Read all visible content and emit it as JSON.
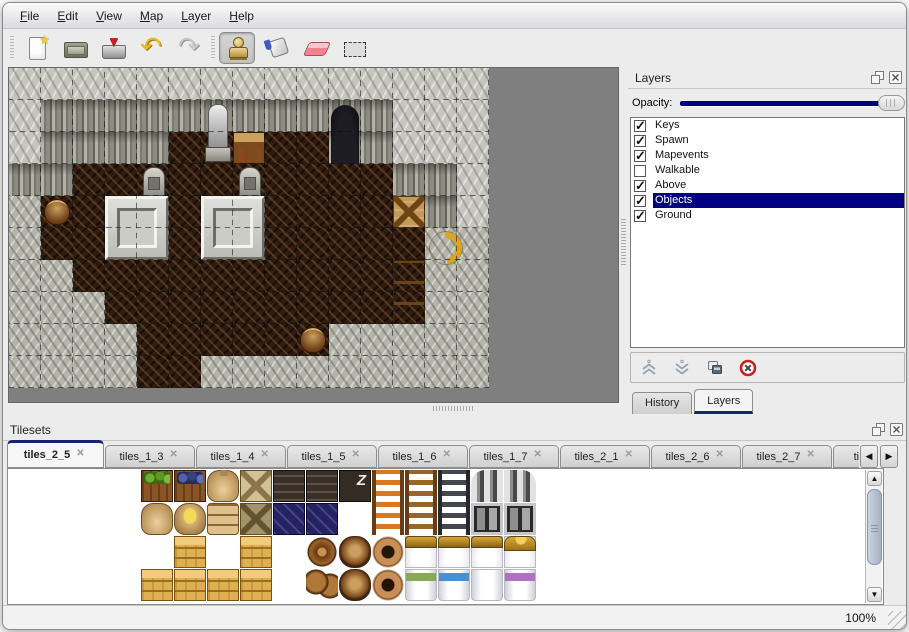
{
  "colors": {
    "accent": "#000080",
    "map_background": "#7f7f7f",
    "panel_background": "#ececec"
  },
  "menu_bar": {
    "items": [
      {
        "label": "File"
      },
      {
        "label": "Edit"
      },
      {
        "label": "View"
      },
      {
        "label": "Map"
      },
      {
        "label": "Layer"
      },
      {
        "label": "Help"
      }
    ]
  },
  "toolbar": {
    "file_group": [
      {
        "name": "new"
      },
      {
        "name": "open"
      },
      {
        "name": "save"
      }
    ],
    "history_group": [
      {
        "name": "undo"
      },
      {
        "name": "redo"
      }
    ],
    "tool_group": [
      {
        "name": "stamp",
        "selected": true
      },
      {
        "name": "fill",
        "selected": false
      },
      {
        "name": "eraser",
        "selected": false
      },
      {
        "name": "select",
        "selected": false
      }
    ]
  },
  "map_view": {
    "tile_size": 32,
    "cols": 15,
    "rows": 10,
    "grid": [
      "TTTTTTTTTTTTTTT",
      "TWWWWWWWWWWWTTT",
      "TWWWWFFFFFWWTTT",
      "WWFFFFFFFFFFWWT",
      "RFFFFFFFFFFFFWT",
      "RFFFFFFFFFFFFRR",
      "RRFFFFFFFFFFFRR",
      "RRRFFFFFFFFFFRR",
      "RRRRFFFFFFRRRRR",
      "RRRRFFRRRRRRRRR"
    ],
    "objects": [
      {
        "kind": "door",
        "col": 10,
        "row": 1,
        "w": 1,
        "h": 2
      },
      {
        "kind": "statue",
        "col": 6,
        "row": 1,
        "w": 1,
        "h": 2
      },
      {
        "kind": "table",
        "col": 7,
        "row": 2,
        "w": 1,
        "h": 1
      },
      {
        "kind": "gravestone",
        "col": 4,
        "row": 3,
        "w": 1,
        "h": 1
      },
      {
        "kind": "gravestone",
        "col": 7,
        "row": 3,
        "w": 1,
        "h": 1
      },
      {
        "kind": "altar",
        "col": 3,
        "row": 4,
        "w": 2,
        "h": 2
      },
      {
        "kind": "altar",
        "col": 6,
        "row": 4,
        "w": 2,
        "h": 2
      },
      {
        "kind": "barrel",
        "col": 1,
        "row": 4,
        "w": 1,
        "h": 1
      },
      {
        "kind": "crate-tools",
        "col": 12,
        "row": 4,
        "w": 1,
        "h": 1
      },
      {
        "kind": "horn",
        "col": 13,
        "row": 5,
        "w": 1,
        "h": 1
      },
      {
        "kind": "cabinet",
        "col": 12,
        "row": 6,
        "w": 1,
        "h": 2
      },
      {
        "kind": "barrel",
        "col": 9,
        "row": 8,
        "w": 1,
        "h": 1
      }
    ]
  },
  "layers_panel": {
    "title": "Layers",
    "opacity_label": "Opacity:",
    "opacity_value": 100,
    "layers": [
      {
        "name": "Keys",
        "checked": true,
        "selected": false
      },
      {
        "name": "Spawn",
        "checked": true,
        "selected": false
      },
      {
        "name": "Mapevents",
        "checked": true,
        "selected": false
      },
      {
        "name": "Walkable",
        "checked": false,
        "selected": false
      },
      {
        "name": "Above",
        "checked": true,
        "selected": false
      },
      {
        "name": "Objects",
        "checked": true,
        "selected": true
      },
      {
        "name": "Ground",
        "checked": true,
        "selected": false
      }
    ],
    "buttons": [
      {
        "name": "raise-layer"
      },
      {
        "name": "lower-layer"
      },
      {
        "name": "duplicate-layer"
      },
      {
        "name": "delete-layer"
      }
    ],
    "tabs": [
      {
        "label": "History",
        "active": false
      },
      {
        "label": "Layers",
        "active": true
      }
    ]
  },
  "tilesets_panel": {
    "title": "Tilesets",
    "tabs": [
      {
        "label": "tiles_2_5",
        "active": true
      },
      {
        "label": "tiles_1_3",
        "active": false
      },
      {
        "label": "tiles_1_4",
        "active": false
      },
      {
        "label": "tiles_1_5",
        "active": false
      },
      {
        "label": "tiles_1_6",
        "active": false
      },
      {
        "label": "tiles_1_7",
        "active": false
      },
      {
        "label": "tiles_2_1",
        "active": false
      },
      {
        "label": "tiles_2_6",
        "active": false
      },
      {
        "label": "tiles_2_7",
        "active": false
      },
      {
        "label": "tiles_2",
        "active": false
      }
    ],
    "items": [
      {
        "kind": "shelf-dishes",
        "c": 0,
        "r": 0,
        "h": 2
      },
      {
        "kind": "shelf-red",
        "c": 1,
        "r": 0,
        "h": 2
      },
      {
        "kind": "shelf-mixed",
        "c": 2,
        "r": 0,
        "h": 2
      },
      {
        "kind": "shelf-jars",
        "c": 3,
        "r": 0,
        "h": 2
      },
      {
        "kind": "shelf-bottles",
        "c": 0,
        "r": 2,
        "h": 2
      },
      {
        "kind": "shelf-books",
        "c": 1,
        "r": 2,
        "h": 2
      },
      {
        "kind": "shelf-books2",
        "c": 2,
        "r": 2,
        "h": 2
      },
      {
        "kind": "shelf-books3",
        "c": 3,
        "r": 2,
        "h": 2
      },
      {
        "kind": "crate-veg",
        "c": 4,
        "r": 0
      },
      {
        "kind": "crate-grapes",
        "c": 5,
        "r": 0
      },
      {
        "kind": "sack",
        "c": 6,
        "r": 0
      },
      {
        "kind": "crate-x-light",
        "c": 7,
        "r": 0
      },
      {
        "kind": "crate-dark",
        "c": 8,
        "r": 0
      },
      {
        "kind": "crate-dark2",
        "c": 9,
        "r": 0
      },
      {
        "kind": "crate-z",
        "c": 10,
        "r": 0
      },
      {
        "kind": "ladder-orange",
        "c": 11,
        "r": 0,
        "h": 2
      },
      {
        "kind": "ladder-brown",
        "c": 12,
        "r": 0,
        "h": 2
      },
      {
        "kind": "ladder-dark",
        "c": 13,
        "r": 0,
        "h": 2
      },
      {
        "kind": "arch-left",
        "c": 14,
        "r": 0
      },
      {
        "kind": "arch-right",
        "c": 15,
        "r": 0
      },
      {
        "kind": "arch-door",
        "c": 14,
        "r": 1
      },
      {
        "kind": "arch-door",
        "c": 15,
        "r": 1
      },
      {
        "kind": "sack-round",
        "c": 4,
        "r": 1
      },
      {
        "kind": "sack-open",
        "c": 5,
        "r": 1
      },
      {
        "kind": "sack-pile",
        "c": 6,
        "r": 1
      },
      {
        "kind": "crate-x-dark",
        "c": 7,
        "r": 1
      },
      {
        "kind": "crate-navy",
        "c": 8,
        "r": 1
      },
      {
        "kind": "crate-navy2",
        "c": 9,
        "r": 1
      },
      {
        "kind": "crate-gold",
        "c": 5,
        "r": 2
      },
      {
        "kind": "crate-gold",
        "c": 7,
        "r": 2
      },
      {
        "kind": "barrels",
        "c": 9,
        "r": 2,
        "h": 2
      },
      {
        "kind": "barrel",
        "c": 10,
        "r": 2
      },
      {
        "kind": "pots",
        "c": 11,
        "r": 2,
        "h": 2
      },
      {
        "kind": "bed-head",
        "c": 12,
        "r": 2
      },
      {
        "kind": "bed-head",
        "c": 13,
        "r": 2
      },
      {
        "kind": "bed-head",
        "c": 14,
        "r": 2
      },
      {
        "kind": "bed-head-gold",
        "c": 15,
        "r": 2
      },
      {
        "kind": "crate-gold",
        "c": 4,
        "r": 3
      },
      {
        "kind": "crate-gold",
        "c": 5,
        "r": 3
      },
      {
        "kind": "crate-gold",
        "c": 6,
        "r": 3
      },
      {
        "kind": "crate-gold",
        "c": 7,
        "r": 3
      },
      {
        "kind": "barrel",
        "c": 10,
        "r": 3
      },
      {
        "kind": "bed-green",
        "c": 12,
        "r": 3
      },
      {
        "kind": "bed-blue",
        "c": 13,
        "r": 3
      },
      {
        "kind": "bed-white",
        "c": 14,
        "r": 3
      },
      {
        "kind": "bed-purple",
        "c": 15,
        "r": 3
      }
    ]
  },
  "status_bar": {
    "zoom": "100%"
  }
}
